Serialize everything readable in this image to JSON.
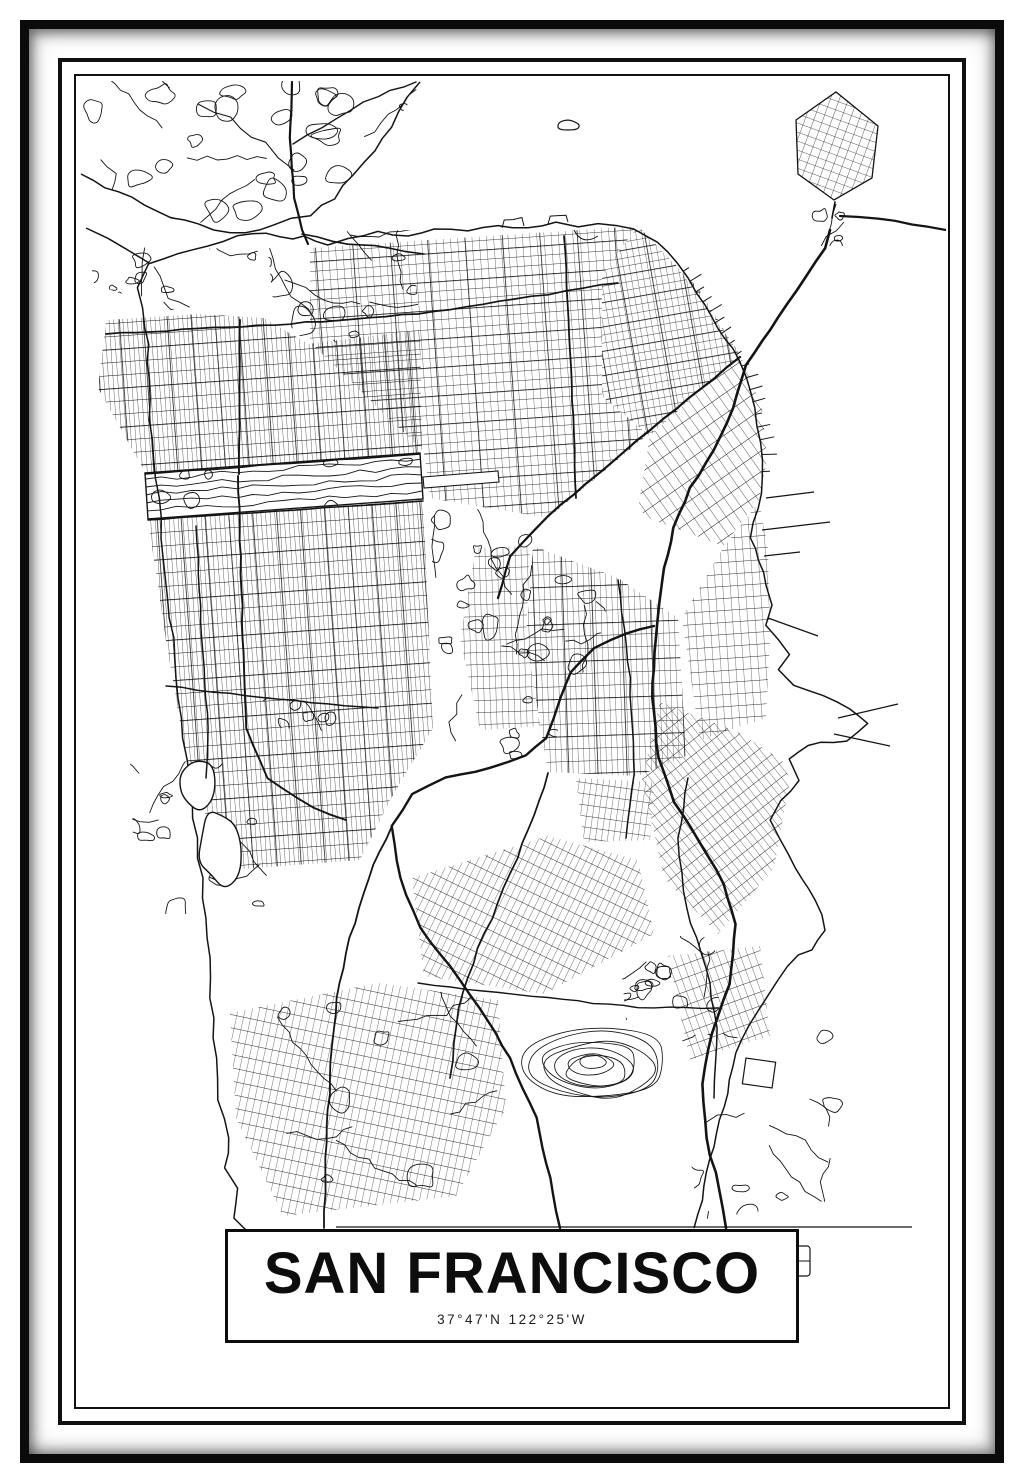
{
  "poster": {
    "title": "SAN FRANCISCO",
    "coordinates": "37°47'N 122°25'W",
    "colors": {
      "ink": "#0d0d0d",
      "paper": "#ffffff"
    }
  }
}
